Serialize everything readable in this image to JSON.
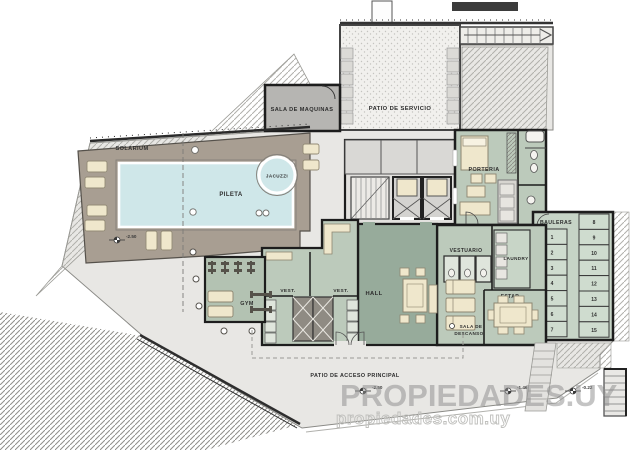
{
  "plan": {
    "title": "floor-plan-amenities-level",
    "labels": {
      "solarium": "SOLARIUM",
      "jacuzzi": "JACUZZI",
      "pileta": "PILETA",
      "sala_de_maquinas": "SALA DE MAQUINAS",
      "patio_de_servicio": "PATIO DE SERVICIO",
      "porteria": "PORTERIA",
      "vestuario": "VESTUARIO",
      "laundry": "LAUNDRY",
      "estar": "ESTAR",
      "sala_de_descanso_line1": "SALA DE",
      "sala_de_descanso_line2": "DESCANSO",
      "gym": "GYM",
      "vest_left": "VEST.",
      "vest_right": "VEST.",
      "hall": "HALL",
      "patio_acceso": "PATIO DE ACCESO PRINCIPAL"
    },
    "bauleras": {
      "title": "BAULERAS",
      "col_left": [
        "1",
        "2",
        "3",
        "4",
        "5",
        "6",
        "7"
      ],
      "col_right": [
        "8",
        "9",
        "10",
        "11",
        "12",
        "13",
        "14",
        "15"
      ]
    },
    "elevation_markers": [
      "-2.50",
      "-2.50",
      "-1.46",
      "-0.22"
    ],
    "watermark": {
      "line1": "PROPIEDADES.UY",
      "line2": "propiedades.com.uy"
    },
    "colors": {
      "deck_taupe": "#a89e92",
      "pool_water": "#cfe7e9",
      "room_sage": "#bccabb",
      "hall_green": "#97ab9b",
      "gym_green": "#b3c2b2",
      "bauleras_green": "#c6d4c6",
      "machine_room_gray": "#b6b5b2",
      "ground_gray": "#e8e7e4",
      "wall_dark": "#1d1d1d",
      "furniture_cream": "#efe7cc",
      "watermark_gray": "#8f8f8f"
    }
  }
}
